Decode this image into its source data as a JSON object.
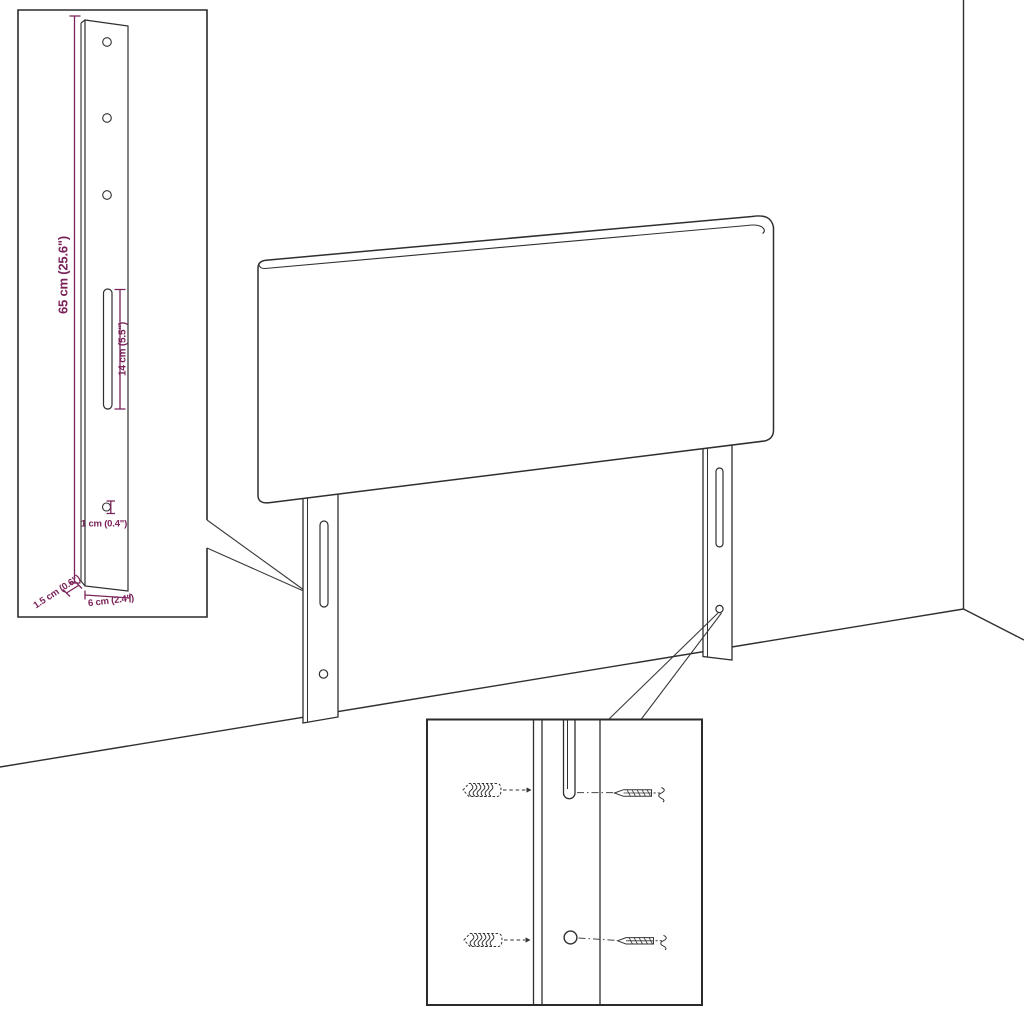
{
  "colors": {
    "background": "#ffffff",
    "line": "#2f2f2f",
    "accent": "#7a2359"
  },
  "bracket_detail": {
    "dimensions": {
      "height": "65 cm (25.6\")",
      "slot_length": "14 cm (5.5\")",
      "hole_diameter": "1 cm (0.4\")",
      "thickness": "1.5 cm (0.6\")",
      "width": "6 cm (2.4\")"
    },
    "visible_parts": {
      "screw_holes": 3,
      "slots": 1,
      "anchor_holes": 1
    }
  },
  "hardware_detail": {
    "wall_plugs": 2,
    "screws": 2,
    "icon_names": [
      "wall-plug-icon",
      "screw-icon",
      "slot-icon",
      "hole-icon"
    ]
  },
  "scene": {
    "object_names": [
      "room-corner",
      "headboard-panel",
      "left-mounting-leg",
      "right-mounting-leg",
      "bracket-detail-box",
      "hardware-detail-box"
    ]
  }
}
